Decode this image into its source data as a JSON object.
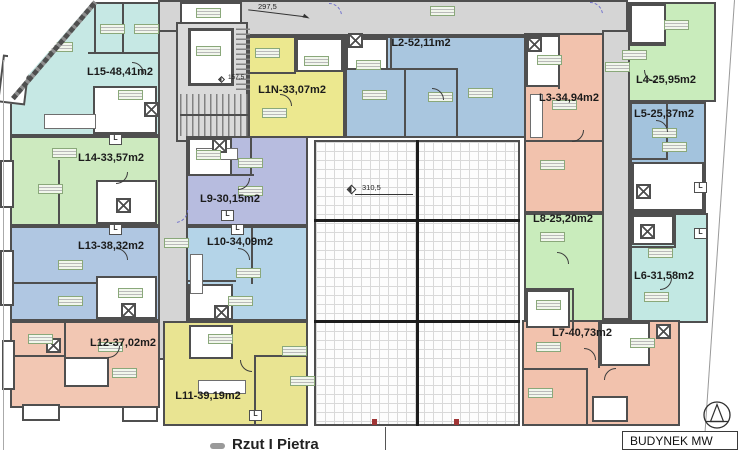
{
  "plan_title": "Rzut I Pietra",
  "building_box_label": "BUDYNEK MW",
  "annotations": {
    "top_dimension": "297,5",
    "stair_level": "157,5",
    "roof_level": "310,5",
    "vent_label": "L"
  },
  "apartments": [
    {
      "id": "L15",
      "label": "L15-48,41m2",
      "color": "#c6e8e4"
    },
    {
      "id": "L14",
      "label": "L14-33,57m2",
      "color": "#cdeabf"
    },
    {
      "id": "L13",
      "label": "L13-38,32m2",
      "color": "#b0c7e2"
    },
    {
      "id": "L12",
      "label": "L12-37,02m2",
      "color": "#f2c7b3"
    },
    {
      "id": "L11",
      "label": "L11-39,19m2",
      "color": "#e9e492"
    },
    {
      "id": "L10",
      "label": "L10-34,09m2",
      "color": "#b4d4e8"
    },
    {
      "id": "L9",
      "label": "L9-30,15m2",
      "color": "#b7bcdf"
    },
    {
      "id": "L1N",
      "label": "L1N-33,07m2",
      "color": "#ece88f"
    },
    {
      "id": "L2",
      "label": "L2-52,11m2",
      "color": "#a9c6df"
    },
    {
      "id": "L3",
      "label": "L3-34,94m2",
      "color": "#f2c2ad"
    },
    {
      "id": "L4",
      "label": "L4-25,95m2",
      "color": "#c9ecbc"
    },
    {
      "id": "L5",
      "label": "L5-25,37m2",
      "color": "#a3c3dd"
    },
    {
      "id": "L8",
      "label": "L8-25,20m2",
      "color": "#c9ecbc"
    },
    {
      "id": "L6",
      "label": "L6-31,58m2",
      "color": "#c2e8e3"
    },
    {
      "id": "L7",
      "label": "L7-40,73m2",
      "color": "#f2c2ad"
    }
  ]
}
